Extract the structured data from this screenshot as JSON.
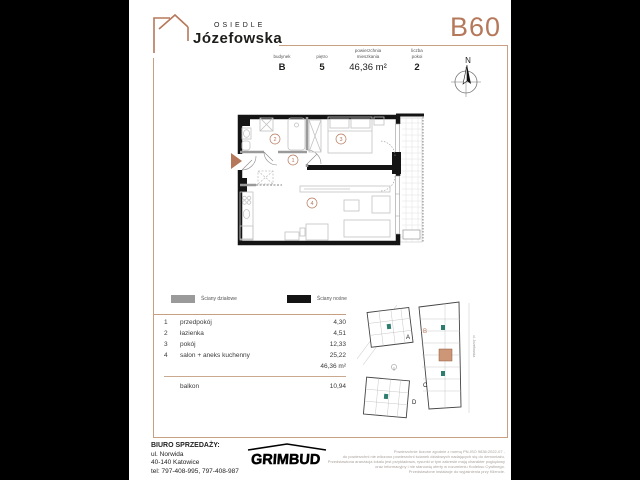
{
  "colors": {
    "accent": "#b5785a",
    "frame_line": "#c79f82",
    "wall_bearing": "#141414",
    "wall_partition": "#9a9a9a",
    "site_highlight": "#cc9677"
  },
  "header": {
    "estate_name_line1": "OSIEDLE",
    "estate_name_line2": "Józefowska",
    "unit_code": "B60",
    "info": [
      {
        "label": "budynek",
        "value": "B"
      },
      {
        "label": "piętro",
        "value": "5"
      },
      {
        "label": "powierzchnia mieszkania",
        "value": "46,36 m²"
      },
      {
        "label": "liczba pokoi",
        "value": "2"
      }
    ],
    "compass_north": "N"
  },
  "legend": {
    "partition": "Ściany działowe",
    "bearing": "Ściany nośne"
  },
  "rooms": [
    {
      "no": "1",
      "name": "przedpokój",
      "area": "4,30"
    },
    {
      "no": "2",
      "name": "łazienka",
      "area": "4,51"
    },
    {
      "no": "3",
      "name": "pokój",
      "area": "12,33"
    },
    {
      "no": "4",
      "name": "salon + aneks kuchenny",
      "area": "25,22"
    }
  ],
  "total_area": "46,36 m²",
  "balcony": {
    "name": "balkon",
    "area": "10,94"
  },
  "site_plan": {
    "labels": {
      "a": "A",
      "b": "B",
      "c": "C",
      "d": "D"
    },
    "street": "ul. Józefowska"
  },
  "footer": {
    "office_title": "BIURO SPRZEDAŻY:",
    "office_lines": [
      "ul. Norwida",
      "40-140 Katowice",
      "tel: 797-408-995, 797-408-987"
    ],
    "builder": "GRIMBUD",
    "disclaimer": [
      "Powierzchnie liczone zgodnie z normą PN-ISO 9836:2022-07 -",
      "do powierzchni nie wliczono powierzchni ścianek działowych nadających się do demontażu.",
      "Przedstawiona aranżacja lokalu jest przykładowa, rysunki w tym zakresie mają charakter poglądowy",
      "oraz informacyjny i nie stanowią oferty w rozumieniu Kodeksu Cywilnego.",
      "Przedstawione instalacje do wyjaśnienia przy Kliencie."
    ]
  }
}
